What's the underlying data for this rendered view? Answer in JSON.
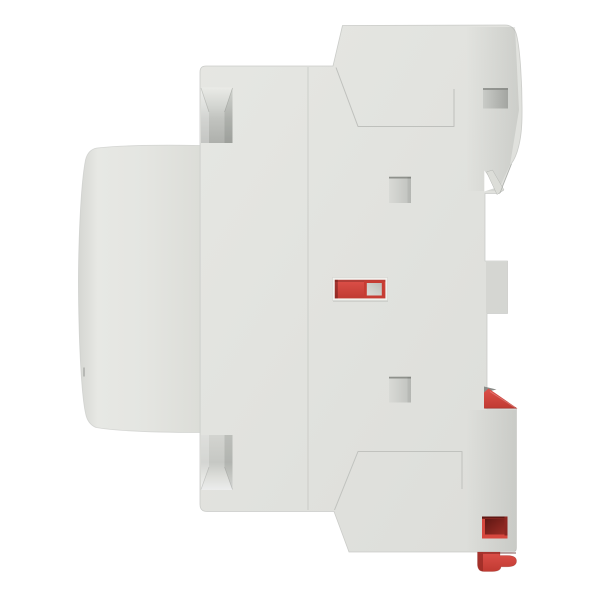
{
  "image": {
    "subject": "side view of a light-gray DIN-rail modular contactor with red on/off indicator and red rail clips",
    "background": "#ffffff"
  },
  "colors": {
    "background": "#ffffff",
    "body": "#e1e2de",
    "body_highlight": "#e8e9e5",
    "body_shadow": "#d2d3cf",
    "edge": "#c6c8c4",
    "seam": "#a7a9a5",
    "slot_edge": "#8f918c",
    "recess_dark": "#b0b2ae",
    "hook_gray": "#8a8c88",
    "wedge": "#dcddd8",
    "frame_light": "#f0f1ed",
    "red": "#d6473e",
    "red_mid": "#c23a32",
    "red_shadow": "#9c2d27",
    "red_dark": "#8e2722",
    "red_deep": "#5f1713",
    "indicator_border": "#c63c33",
    "indicator_gray": "#cbccc8"
  }
}
